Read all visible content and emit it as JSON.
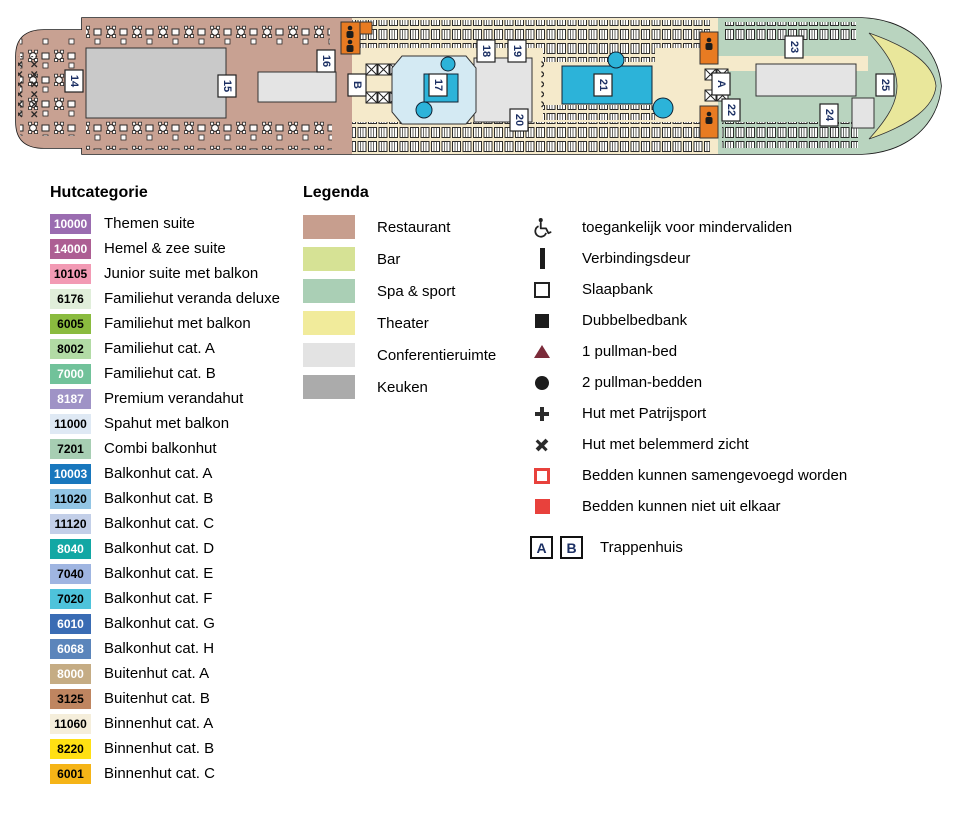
{
  "ship": {
    "marker_text_color": "#1b2f63",
    "colors": {
      "hull_fill": "#ffffff",
      "hull_stroke": "#1a1a1a",
      "restaurant": "#c8a192",
      "deck": "#f5eacb",
      "spa": "#b9d4bf",
      "theater": "#e9e79b",
      "kitchen_block": "#c9c9c9",
      "light_block": "#e4e4e4",
      "pool_blue": "#2cb3d9",
      "pool_light": "#d4eaf3",
      "elevator_orange": "#e87b22"
    },
    "markers": [
      {
        "label": "14",
        "x": 74,
        "y": 81
      },
      {
        "label": "15",
        "x": 227,
        "y": 86
      },
      {
        "label": "16",
        "x": 326,
        "y": 61
      },
      {
        "label": "B",
        "x": 357,
        "y": 85
      },
      {
        "label": "17",
        "x": 438,
        "y": 85
      },
      {
        "label": "18",
        "x": 486,
        "y": 51
      },
      {
        "label": "19",
        "x": 517,
        "y": 51
      },
      {
        "label": "20",
        "x": 519,
        "y": 120
      },
      {
        "label": "21",
        "x": 603,
        "y": 85
      },
      {
        "label": "A",
        "x": 721,
        "y": 84
      },
      {
        "label": "22",
        "x": 731,
        "y": 110
      },
      {
        "label": "23",
        "x": 794,
        "y": 47
      },
      {
        "label": "24",
        "x": 829,
        "y": 115
      },
      {
        "label": "25",
        "x": 885,
        "y": 85
      }
    ]
  },
  "hutcategorie": {
    "title": "Hutcategorie",
    "items": [
      {
        "code": "10000",
        "color": "#9a6cb0",
        "text": "#ffffff",
        "label": "Themen suite"
      },
      {
        "code": "14000",
        "color": "#ad5e93",
        "text": "#ffffff",
        "label": "Hemel & zee suite"
      },
      {
        "code": "10105",
        "color": "#f29ab4",
        "text": "#000000",
        "label": "Junior suite met balkon"
      },
      {
        "code": "6176",
        "color": "#e0eeda",
        "text": "#000000",
        "label": "Familiehut veranda deluxe"
      },
      {
        "code": "6005",
        "color": "#8abb3f",
        "text": "#000000",
        "label": "Familiehut met balkon"
      },
      {
        "code": "8002",
        "color": "#b2dba5",
        "text": "#000000",
        "label": "Familiehut cat. A"
      },
      {
        "code": "7000",
        "color": "#71c29a",
        "text": "#ffffff",
        "label": "Familiehut cat. B"
      },
      {
        "code": "8187",
        "color": "#9f93c6",
        "text": "#ffffff",
        "label": "Premium verandahut"
      },
      {
        "code": "11000",
        "color": "#dfe9f4",
        "text": "#000000",
        "label": "Spahut met balkon"
      },
      {
        "code": "7201",
        "color": "#a7ceb3",
        "text": "#000000",
        "label": "Combi balkonhut"
      },
      {
        "code": "10003",
        "color": "#1877bd",
        "text": "#ffffff",
        "label": "Balkonhut cat. A"
      },
      {
        "code": "11020",
        "color": "#92c5e4",
        "text": "#000000",
        "label": "Balkonhut cat. B"
      },
      {
        "code": "11120",
        "color": "#c3cfe8",
        "text": "#000000",
        "label": "Balkonhut cat. C"
      },
      {
        "code": "8040",
        "color": "#12a7a4",
        "text": "#ffffff",
        "label": "Balkonhut cat. D"
      },
      {
        "code": "7040",
        "color": "#9fb5e1",
        "text": "#000000",
        "label": "Balkonhut cat. E"
      },
      {
        "code": "7020",
        "color": "#4ec3db",
        "text": "#000000",
        "label": "Balkonhut cat. F"
      },
      {
        "code": "6010",
        "color": "#3a6cb4",
        "text": "#ffffff",
        "label": "Balkonhut cat. G"
      },
      {
        "code": "6068",
        "color": "#5b85bb",
        "text": "#ffffff",
        "label": "Balkonhut cat. H"
      },
      {
        "code": "8000",
        "color": "#c5ac84",
        "text": "#ffffff",
        "label": "Buitenhut cat. A"
      },
      {
        "code": "3125",
        "color": "#bf8560",
        "text": "#000000",
        "label": "Buitenhut cat. B"
      },
      {
        "code": "11060",
        "color": "#f5eedb",
        "text": "#000000",
        "label": "Binnenhut cat. A"
      },
      {
        "code": "8220",
        "color": "#ffe013",
        "text": "#000000",
        "label": "Binnenhut cat. B"
      },
      {
        "code": "6001",
        "color": "#f5b417",
        "text": "#000000",
        "label": "Binnenhut cat. C"
      }
    ]
  },
  "legenda": {
    "title": "Legenda",
    "areas": [
      {
        "label": "Restaurant",
        "color": "#c79e8e"
      },
      {
        "label": "Bar",
        "color": "#d6e295"
      },
      {
        "label": "Spa & sport",
        "color": "#aacfb5"
      },
      {
        "label": "Theater",
        "color": "#f1eb9b"
      },
      {
        "label": "Conferentieruimte",
        "color": "#e3e3e3"
      },
      {
        "label": "Keuken",
        "color": "#ababab"
      }
    ]
  },
  "symbols": {
    "items": [
      {
        "icon": "wheelchair-icon",
        "label": "toegankelijk voor mindervaliden"
      },
      {
        "icon": "connecting-door-icon",
        "label": "Verbindingsdeur"
      },
      {
        "icon": "sofa-bed-icon",
        "label": "Slaapbank"
      },
      {
        "icon": "double-sofa-bed-icon",
        "label": "Dubbelbedbank"
      },
      {
        "icon": "pullman-1-icon",
        "label": "1 pullman-bed"
      },
      {
        "icon": "pullman-2-icon",
        "label": "2 pullman-bedden"
      },
      {
        "icon": "porthole-icon",
        "label": "Hut met Patrijsport"
      },
      {
        "icon": "obstructed-view-icon",
        "label": "Hut met belemmerd zicht"
      },
      {
        "icon": "beds-joinable-icon",
        "label": "Bedden kunnen samengevoegd worden"
      },
      {
        "icon": "beds-fixed-icon",
        "label": "Bedden kunnen niet uit elkaar"
      }
    ],
    "trappenhuis": {
      "boxes": [
        "A",
        "B"
      ],
      "label": "Trappenhuis"
    }
  }
}
